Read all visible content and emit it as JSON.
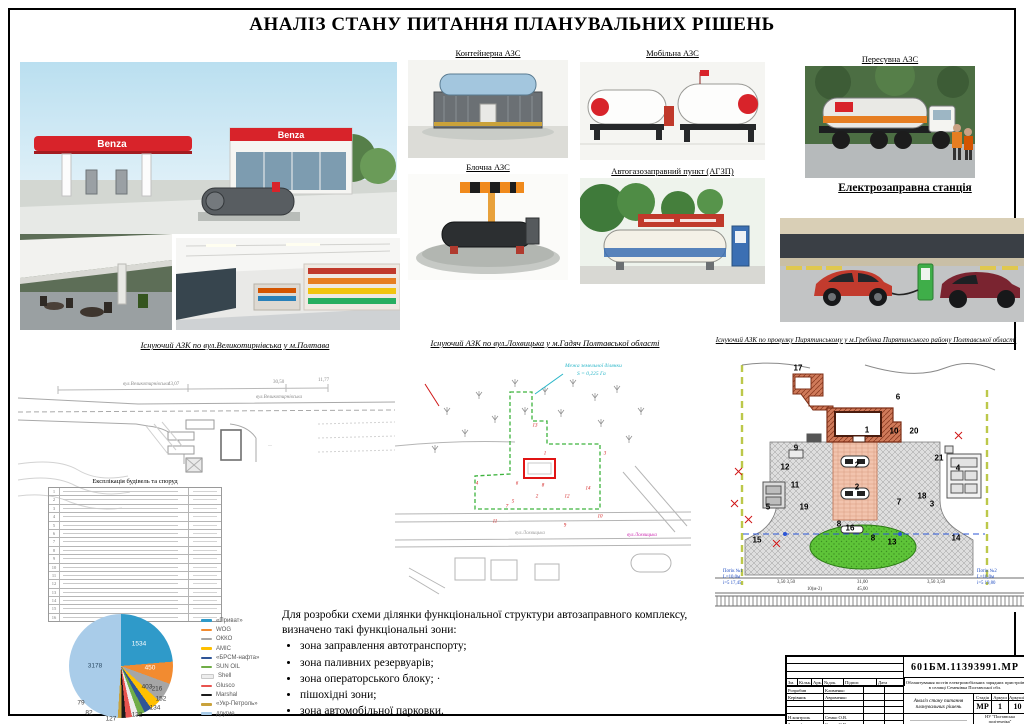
{
  "page": {
    "title": "АНАЛІЗ СТАНУ ПИТАННЯ ПЛАНУВАЛЬНИХ РІШЕНЬ"
  },
  "gallery": {
    "benza_sign": "Benza",
    "container_caption": "Контейнерна АЗС",
    "block_caption": "Блочна АЗС",
    "mobile_caption": "Мобільна АЗС",
    "agzp_caption": "Автогазозаправний пункт (АГЗП)",
    "towable_caption": "Пересувна АЗС",
    "ev_caption": "Електрозаправна станція"
  },
  "plans": {
    "left": {
      "caption": "Існуючий АЗК по вул.Великотирнівська у м.Полтава",
      "street": "вул.Великотирнівська",
      "dims": [
        "43,07",
        "30,50",
        "11,77"
      ],
      "table_title": "Експлікація будівель та споруд",
      "rows": [
        "1",
        "2",
        "3",
        "4",
        "5",
        "6",
        "7",
        "8",
        "9",
        "10",
        "11",
        "12",
        "13",
        "14",
        "15",
        "16"
      ]
    },
    "middle": {
      "caption": "Існуючий АЗК по вул.Лохвицька у м.Гадяч Полтавської області",
      "boundary_note_line1": "Межа земельної ділянки",
      "boundary_note_line2": "S = 0,225 Га",
      "street": "вул.Лохвицька",
      "numbers": [
        "13",
        "1",
        "3",
        "4",
        "6",
        "8",
        "2",
        "12",
        "14",
        "5",
        "7",
        "11",
        "10",
        "9"
      ]
    },
    "right": {
      "caption": "Існуючий АЗК по провулку Пирятинському у м.Гребінка Пирятинського району  Полтавської області",
      "numbers": [
        "17",
        "6",
        "1",
        "10",
        "20",
        "9",
        "12",
        "11",
        "5",
        "19",
        "2",
        "2",
        "21",
        "4",
        "18",
        "3",
        "7",
        "8",
        "16",
        "8",
        "13",
        "15",
        "14"
      ],
      "flow1": "Потік №1",
      "flow1_len": "L=10,0м",
      "flow1_mark": "і=5   17,45",
      "flow2": "Потік №2",
      "flow2_len": "L=10,0м",
      "flow2_mark": "і=5   19,80",
      "dims": [
        "3,50 3,50",
        "31,00",
        "3,50 3,50",
        "10(м-2)",
        "45,00"
      ]
    }
  },
  "notes": {
    "intro1": "Для розробки схеми ділянки функціональної структури автозаправного комплексу,",
    "intro2": "визначено такі функціональні зони:",
    "bullets": [
      "зона заправлення автотранспорту;",
      "зона паливних резервуарів;",
      "зона операторського блоку; ·",
      "пішохідні зони;",
      "зона автомобільної парковки."
    ]
  },
  "chart_data": {
    "type": "pie",
    "title": "",
    "legend_position": "right",
    "series": [
      {
        "name": "«Приват»",
        "value": 1534,
        "color": "#2f9ac9"
      },
      {
        "name": "WOG",
        "value": 450,
        "color": "#f28b30"
      },
      {
        "name": "ОККО",
        "value": 403,
        "color": "#a6a6a6"
      },
      {
        "name": "AMIC",
        "value": 216,
        "color": "#ffc000"
      },
      {
        "name": "«БРСМ-нафта»",
        "value": 152,
        "color": "#2f5597"
      },
      {
        "name": "SUN OIL",
        "value": 134,
        "color": "#70ad47"
      },
      {
        "name": "Shell",
        "value": 132,
        "color": "#ededed"
      },
      {
        "name": "Glusco",
        "value": 127,
        "color": "#e8534f"
      },
      {
        "name": "Marshal",
        "value": 82,
        "color": "#1a1a1a"
      },
      {
        "name": "«Укр-Петроль»",
        "value": 79,
        "color": "#c9a23b"
      },
      {
        "name": "другие",
        "value": 3178,
        "color": "#a9cce9"
      }
    ]
  },
  "titleblock": {
    "doc_number": "601БМ.11393991.МР",
    "project_line1": "Облаштування постів електромобільних зарядних пристроїв",
    "project_line2": "в селищі Семенівка Полтавської обл.",
    "sheet_title": "Аналіз стану питання планувальних рішень",
    "stage_label": "Стадія",
    "stage": "МР",
    "sheet_label": "Аркуш",
    "sheet": "1",
    "sheets_label": "Аркушів",
    "sheets": "10",
    "org_line1": "НУ \"Полтавська політехніка\"",
    "org_line2": "ім. Юрія Кондратюка",
    "org_line3": "Кафедра БіД",
    "cols": [
      "Зм.",
      "Кільк.",
      "Арк.",
      "№док.",
      "Підпис",
      "Дата"
    ],
    "roles": [
      {
        "role": "Розробив",
        "name": "Клименко"
      },
      {
        "role": "Керівник",
        "name": "Авраменко"
      },
      {
        "role": "",
        "name": ""
      },
      {
        "role": "",
        "name": ""
      },
      {
        "role": "Н.контроль",
        "name": "Семко О.В."
      },
      {
        "role": "Зав.кафедри",
        "name": "Семко О.В."
      }
    ]
  }
}
